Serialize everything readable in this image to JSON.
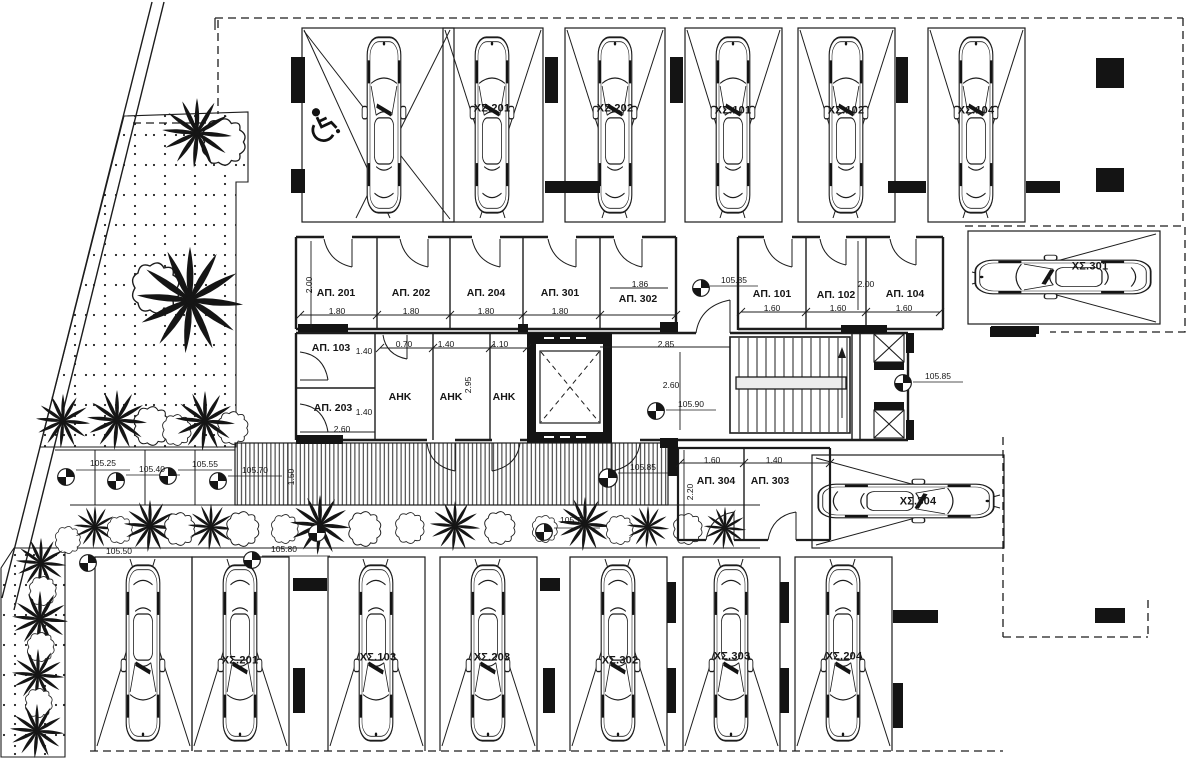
{
  "plan": {
    "stalls": {
      "top": [
        "ΧΣ.201",
        "ΧΣ.202",
        "ΧΣ.101",
        "ΧΣ.102",
        "ΧΣ.104"
      ],
      "right": [
        "ΧΣ.301",
        "ΧΣ.304"
      ],
      "bottom": [
        "ΧΣ.201",
        "ΧΣ.103",
        "ΧΣ.203",
        "ΧΣ.302",
        "ΧΣ.303",
        "ΧΣ.204"
      ]
    },
    "rooms": {
      "ap201": "ΑΠ. 201",
      "ap202": "ΑΠ. 202",
      "ap204": "ΑΠ. 204",
      "ap301": "ΑΠ. 301",
      "ap302": "ΑΠ. 302",
      "ap101": "ΑΠ. 101",
      "ap102": "ΑΠ. 102",
      "ap104": "ΑΠ. 104",
      "ap103": "ΑΠ. 103",
      "ap203": "ΑΠ. 203",
      "ap303": "ΑΠ. 303",
      "ap304": "ΑΠ. 304",
      "ahk": "ΑΗΚ"
    },
    "dims": {
      "d070": "0.70",
      "d110": "1.10",
      "d140": "1.40",
      "d150": "1.50",
      "d160": "1.60",
      "d180": "1.80",
      "d186": "1.86",
      "d200": "2.00",
      "d220": "2.20",
      "d260": "2.60",
      "d285": "2.85",
      "d295": "2.95"
    },
    "levels": {
      "l10525": "105.25",
      "l10540": "105.40",
      "l10550": "105.50",
      "l10555": "105.55",
      "l10570": "105.70",
      "l10575": "105.75",
      "l10580": "105.80",
      "l10585": "105.85",
      "l10590": "105.90"
    },
    "icons": {
      "wheelchair": "accessible-parking",
      "benchmark": "survey-level-marker",
      "palm": "palm-tree",
      "bush": "shrub",
      "car": "car-top-view",
      "elevator": "elevator-shaft",
      "stairs": "staircase"
    },
    "colors": {
      "ink": "#1c1c1c",
      "paper": "#ffffff"
    }
  }
}
